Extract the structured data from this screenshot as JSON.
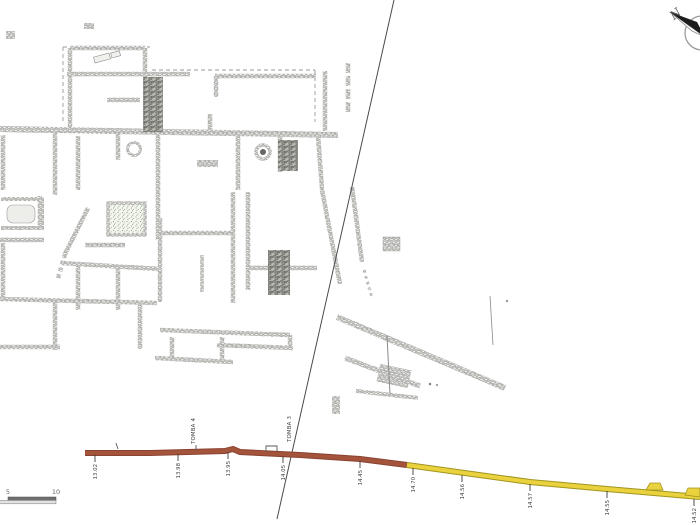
{
  "compass": {
    "label": "N"
  },
  "scale_bar": {
    "labels": [
      "5",
      "10"
    ]
  },
  "section": {
    "tomb_labels": [
      "TOMBA 4",
      "TOMBA 3"
    ],
    "elevations_west": [
      "13.02",
      "13.98",
      "13.95",
      "14.05",
      "14.45"
    ],
    "elevations_east": [
      "14.70",
      "14.56",
      "14.57",
      "14.55",
      "14.52"
    ],
    "colors": {
      "west": "#a4543b",
      "west_edge": "#8a4331",
      "east": "#e9d23e",
      "east_edge": "#a3941f"
    }
  },
  "plan": {
    "mosaic_color": "#6f9356"
  }
}
